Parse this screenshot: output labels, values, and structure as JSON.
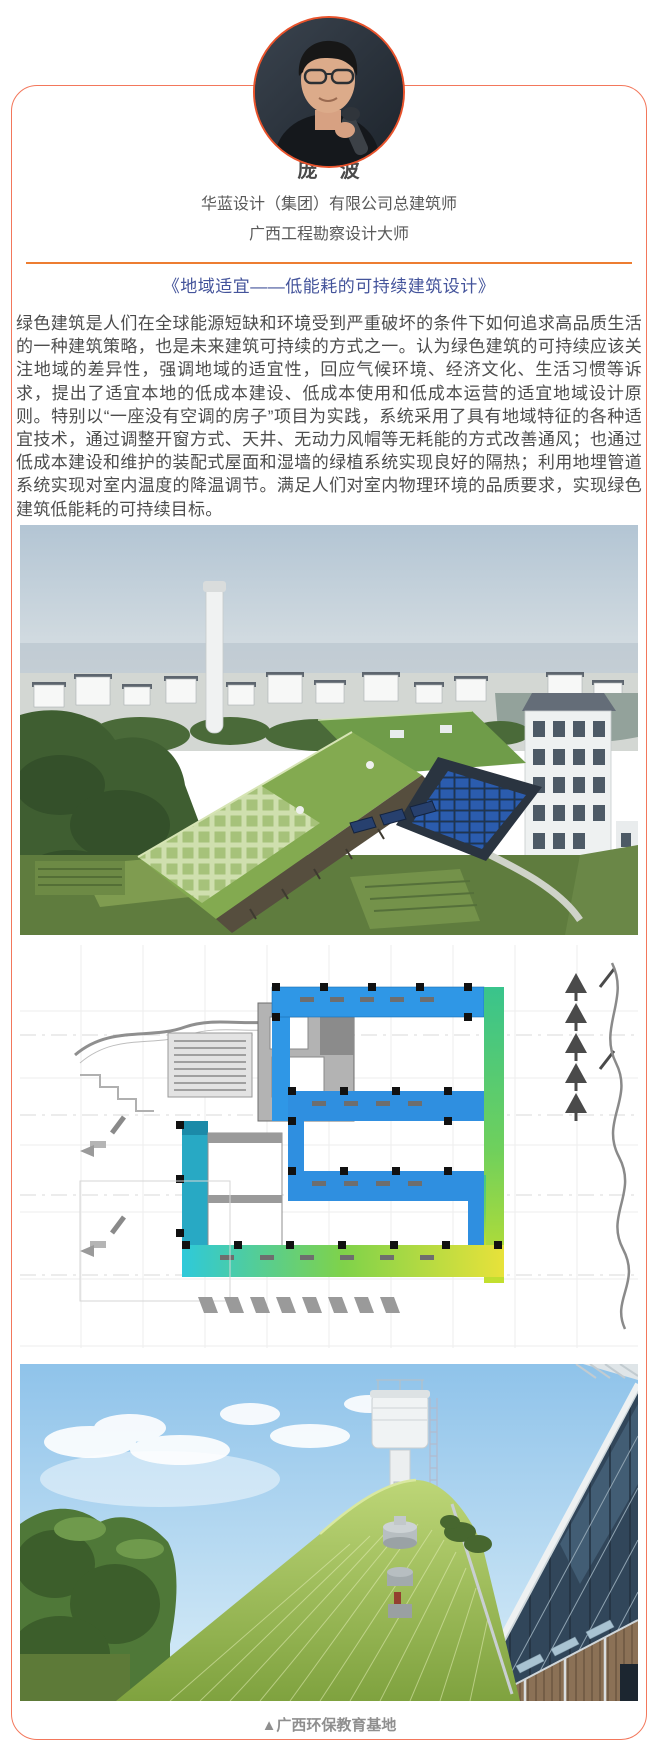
{
  "profile": {
    "name": "庞　波",
    "org_title": "华蓝设计（集团）有限公司总建筑师",
    "honor_title": "广西工程勘察设计大师"
  },
  "lecture": {
    "title": "《地域适宜——低能耗的可持续建筑设计》",
    "abstract": "绿色建筑是人们在全球能源短缺和环境受到严重破坏的条件下如何追求高品质生活的一种建筑策略，也是未来建筑可持续的方式之一。认为绿色建筑的可持续应该关注地域的差异性，强调地域的适宜性，回应气候环境、经济文化、生活习惯等诉求，提出了适宜本地的低成本建设、低成本使用和低成本运营的适宜地域设计原则。特别以“一座没有空调的房子”项目为实践，系统采用了具有地域特征的各种适宜技术，通过调整开窗方式、天井、无动力风帽等无耗能的方式改善通风；也通过低成本建设和维护的装配式屋面和湿墙的绿植系统实现良好的隔热；利用地埋管道系统实现对室内温度的降温调节。满足人们对室内物理环境的品质要求，实现绿色建筑低能耗的可持续目标。"
  },
  "figures": {
    "photo1": "aerial-view-of-green-roof-eco-building",
    "photo2": "site-plan-ventilation-color-diagram",
    "photo3": "grass-roof-with-water-tower",
    "caption": "▲广西环保教育基地"
  },
  "colors": {
    "card_border": "#f3775b",
    "divider": "#ed7d31",
    "lecture_title": "#44549b",
    "body_text": "#4d4d4d",
    "caption_text": "#8f8f8f",
    "avatar_ring": "#e8532c"
  }
}
